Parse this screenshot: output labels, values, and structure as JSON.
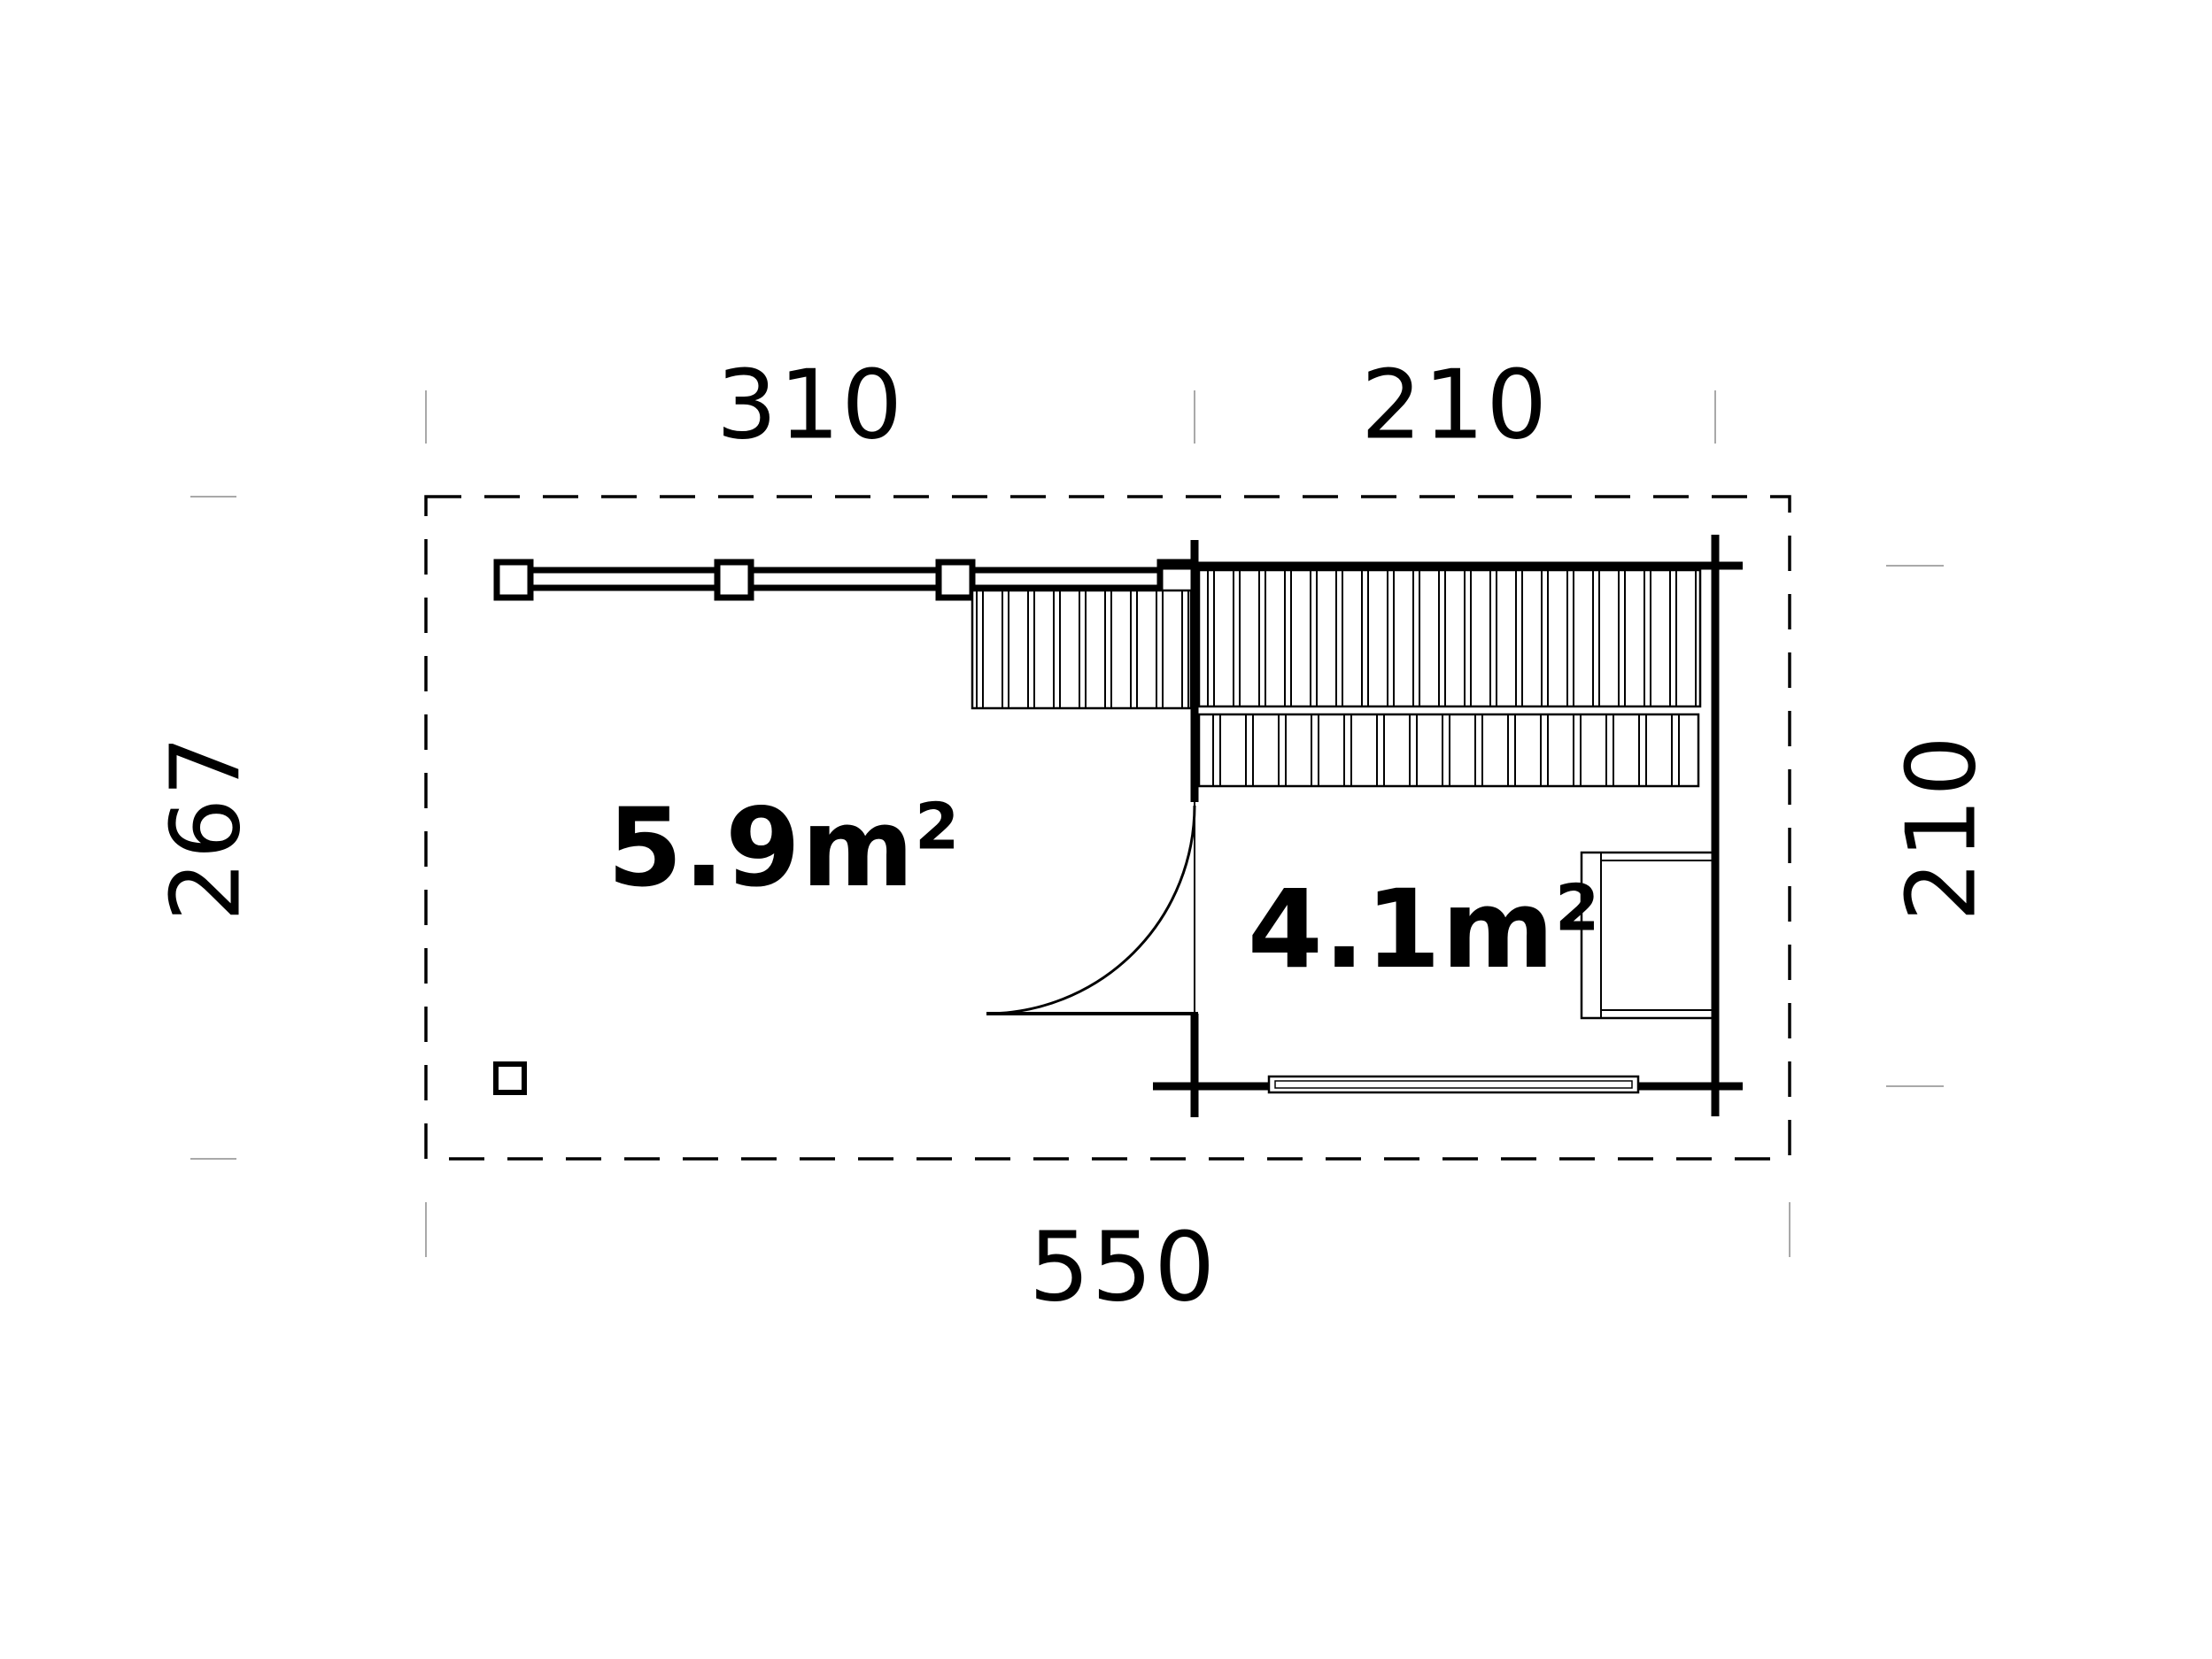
{
  "page": {
    "background": "#ffffff",
    "line_color": "#000000",
    "tick_color": "#a9a9a9"
  },
  "floorplan": {
    "dimension_labels": {
      "top_terrace": "310",
      "top_room": "210",
      "left_overall": "267",
      "right_room": "210",
      "bottom_overall": "550"
    },
    "area_labels": {
      "terrace": {
        "value": "5.9",
        "unit": "m",
        "sup": "2"
      },
      "room": {
        "value": "4.1",
        "unit": "m",
        "sup": "2"
      }
    }
  }
}
